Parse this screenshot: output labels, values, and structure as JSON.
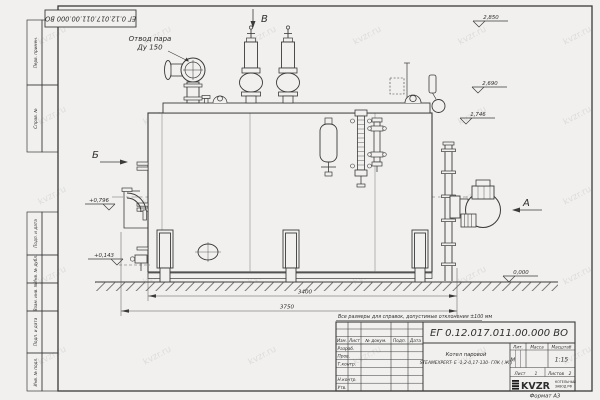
{
  "sheet": {
    "stamp_top": "ЕГ 0.12.017.011.00.000  ВО",
    "ref_note": "Все размеры для справок, допустимые отклонения ±100 мм",
    "format_note": "Формат А3"
  },
  "watermark": {
    "text": "kvzr.ru"
  },
  "margin_cells": {
    "perv": "Перв. примен.",
    "sprav": "Справ. №",
    "podp1": "Подп. и дата",
    "inv_dubl": "Инв. № дубл.",
    "vzam": "Взам. инв. №",
    "podp2": "Подп. и дата",
    "inv_podl": "Инв. № подл."
  },
  "drawing": {
    "callout": {
      "line1": "Отвод пара",
      "line2": "Ду 150"
    },
    "views": {
      "a": "А",
      "b": "Б",
      "v": "В"
    },
    "elevations": {
      "top": "2,850",
      "upper": "2,690",
      "mid": "1,746",
      "left_upper": "+0,796",
      "left_lower": "+0,143",
      "ground": "0,000"
    },
    "dims": {
      "inner": "3400",
      "outer": "3750"
    }
  },
  "title_block": {
    "doc_number": "ЕГ 0.12.017.011.00.000  ВО",
    "header": {
      "izm": "Изм.",
      "list": "Лист",
      "doc": "№ докум.",
      "podp": "Подп.",
      "data": "Дата"
    },
    "rows": {
      "razrab": "Разраб.",
      "prov": "Пров.",
      "tkontr": "Т.контр.",
      "nkontr": "Н.контр.",
      "utv": "Утв."
    },
    "name_line1": "Котел паровой",
    "name_line2": "STEAMEXPERT- Е -1,2-0,17-130- ГЛК ( Ж )",
    "lit_label": "Лит.",
    "lit_value": "М",
    "mass_label": "Масса",
    "scale_label": "Масштаб",
    "scale_value": "1:15",
    "sheet_label": "Лист",
    "sheet_value": "1",
    "sheets_label": "Листов",
    "sheets_value": "2",
    "logo": {
      "text": "KVZR",
      "sub1": "КОТЕЛЬНЫЙ",
      "sub2": "ЗАВОД РФ"
    }
  }
}
